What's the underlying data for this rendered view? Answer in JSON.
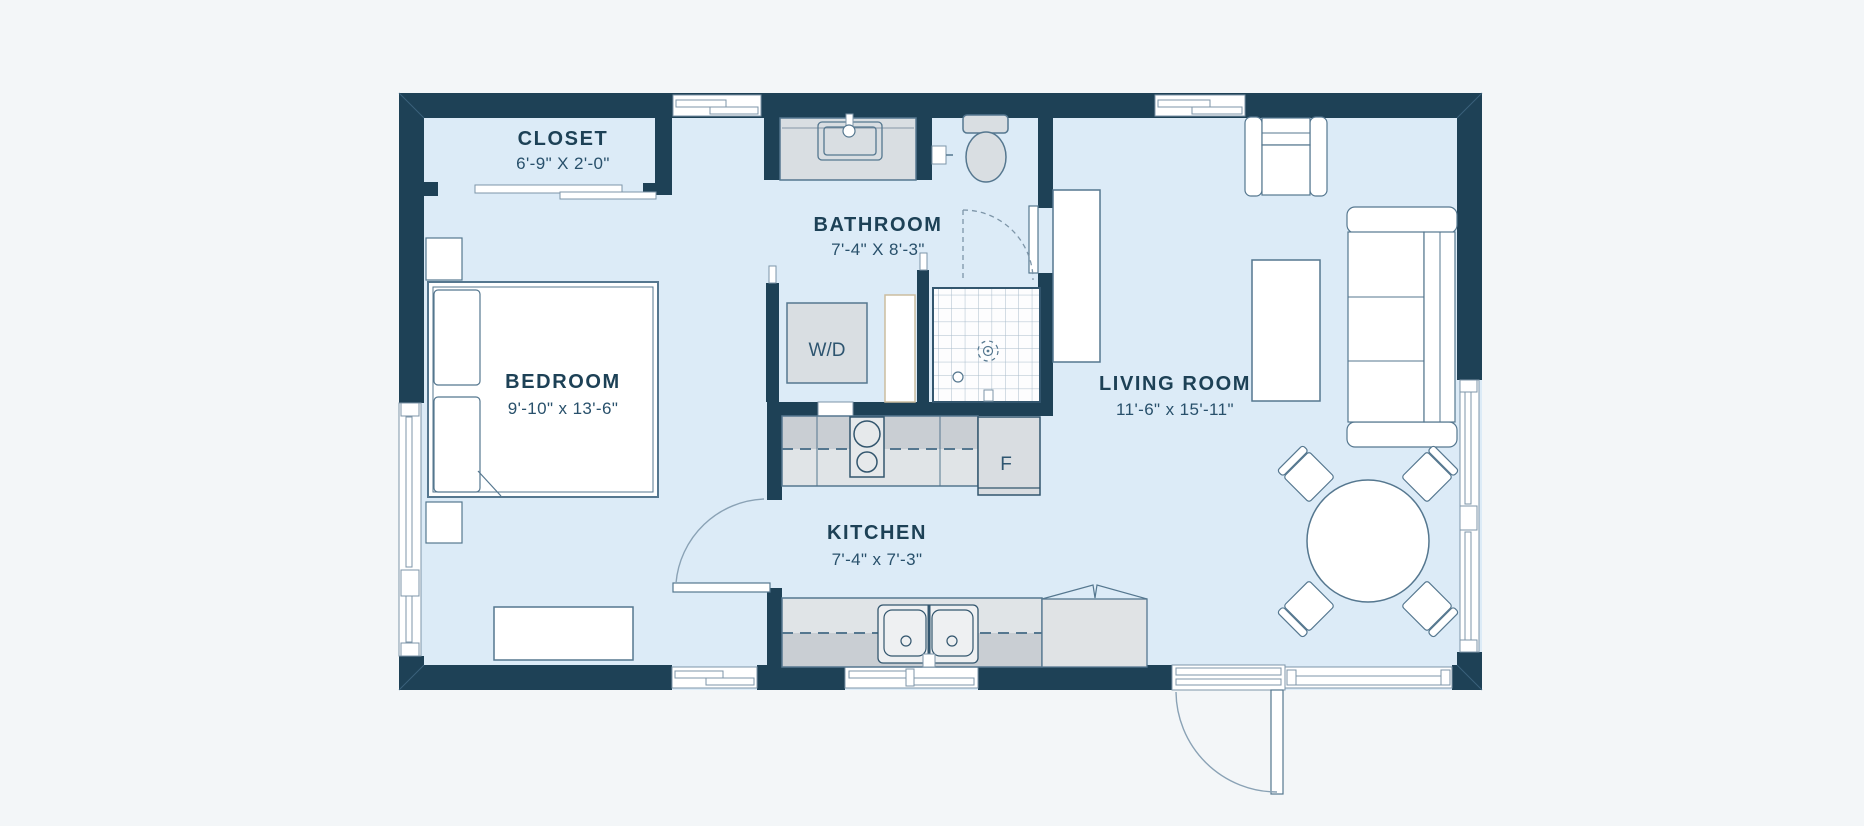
{
  "floorplan": {
    "rooms": [
      {
        "id": "closet",
        "name": "CLOSET",
        "dimensions": "6'-9\" X 2'-0\""
      },
      {
        "id": "bathroom",
        "name": "BATHROOM",
        "dimensions": "7'-4\" X 8'-3\""
      },
      {
        "id": "bedroom",
        "name": "BEDROOM",
        "dimensions": "9'-10\" x 13'-6\""
      },
      {
        "id": "living_room",
        "name": "LIVING ROOM",
        "dimensions": "11'-6\" x 15'-11\""
      },
      {
        "id": "kitchen",
        "name": "KITCHEN",
        "dimensions": "7'-4\" x 7'-3\""
      }
    ],
    "appliances": {
      "washer_dryer": "W/D",
      "fridge": "F"
    },
    "palette": {
      "wall": "#1e4156",
      "floor": "#dcebf7",
      "background": "#f3f6f8",
      "furniture_line": "#55778f",
      "fixture_gray": "#d9dee2",
      "label_text": "#1d4156"
    }
  }
}
